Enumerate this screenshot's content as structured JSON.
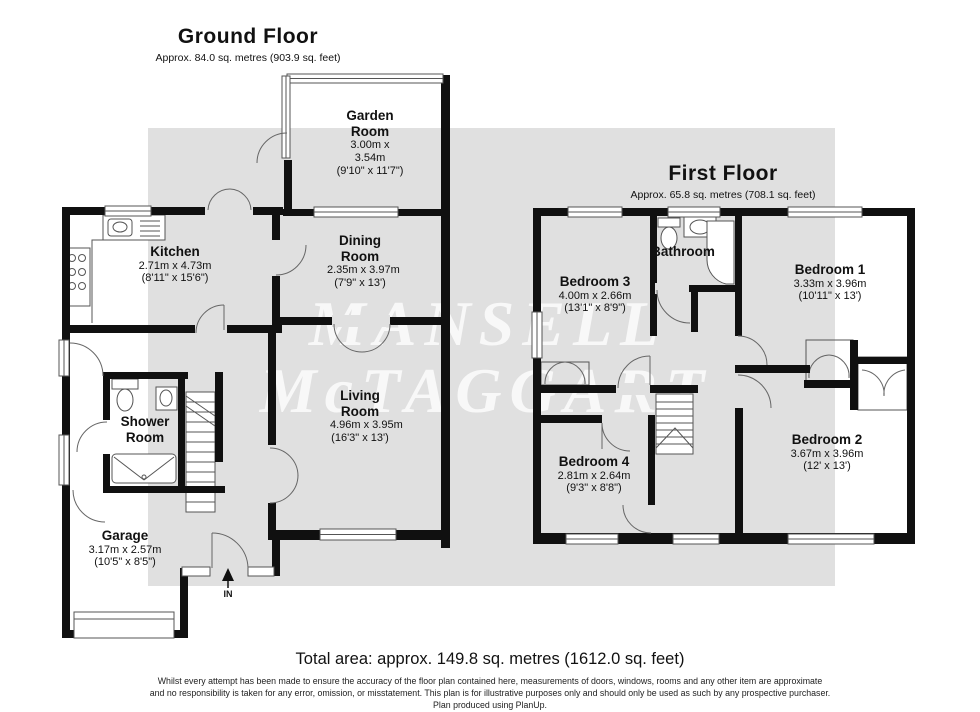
{
  "watermark": {
    "line1": "MANSELL",
    "line2": "McTAGGART"
  },
  "ground_floor": {
    "title": "Ground Floor",
    "subtitle": "Approx. 84.0 sq. metres (903.9 sq. feet)",
    "entrance_label": "IN",
    "rooms": {
      "garden_room": {
        "name": "Garden Room",
        "metric": "3.00m x 3.54m",
        "imperial": "(9'10\" x 11'7\")"
      },
      "kitchen": {
        "name": "Kitchen",
        "metric": "2.71m x 4.73m",
        "imperial": "(8'11\" x 15'6\")"
      },
      "dining_room": {
        "name": "Dining Room",
        "metric": "2.35m x 3.97m",
        "imperial": "(7'9\" x 13')"
      },
      "living_room": {
        "name": "Living Room",
        "metric": "4.96m x 3.95m",
        "imperial": "(16'3\" x 13')"
      },
      "shower_room": {
        "name": "Shower Room"
      },
      "garage": {
        "name": "Garage",
        "metric": "3.17m x 2.57m",
        "imperial": "(10'5\" x 8'5\")"
      }
    }
  },
  "first_floor": {
    "title": "First Floor",
    "subtitle": "Approx. 65.8 sq. metres (708.1 sq. feet)",
    "rooms": {
      "bedroom_1": {
        "name": "Bedroom 1",
        "metric": "3.33m x 3.96m",
        "imperial": "(10'11\" x 13')"
      },
      "bedroom_2": {
        "name": "Bedroom 2",
        "metric": "3.67m x 3.96m",
        "imperial": "(12' x 13')"
      },
      "bedroom_3": {
        "name": "Bedroom 3",
        "metric": "4.00m x 2.66m",
        "imperial": "(13'1\" x 8'9\")"
      },
      "bedroom_4": {
        "name": "Bedroom 4",
        "metric": "2.81m x 2.64m",
        "imperial": "(9'3\" x 8'8\")"
      },
      "bathroom": {
        "name": "Bathroom"
      }
    }
  },
  "footer": {
    "total_area": "Total area: approx. 149.8 sq. metres (1612.0 sq. feet)",
    "disclaimer_line1": "Whilst every attempt has been made to ensure the accuracy of the floor plan contained here, measurements of doors, windows, rooms and any other item are approximate",
    "disclaimer_line2": "and no responsibility is taken for any error, omission, or misstatement. This plan is for illustrative purposes only and should only be used as such by any prospective purchaser.",
    "disclaimer_line3": "Plan produced using PlanUp."
  },
  "colors": {
    "wall": "#101010",
    "watermark_band": "#e0e0e0",
    "line": "#555555"
  }
}
